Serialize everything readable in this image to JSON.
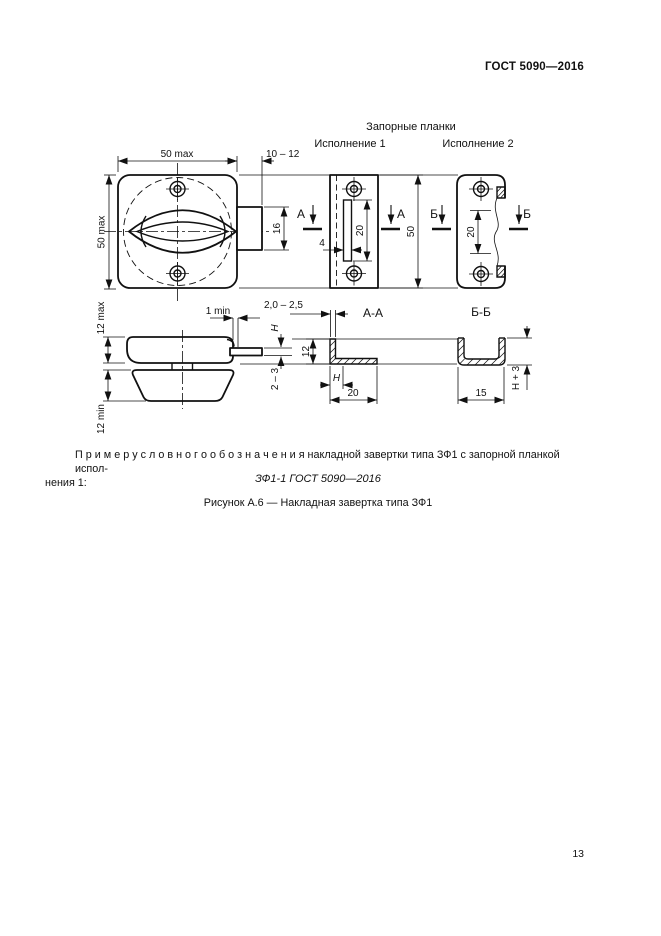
{
  "header": {
    "standard": "ГОСТ 5090—2016"
  },
  "figure": {
    "plates_title": "Запорные планки",
    "variant_1": "Исполнение 1",
    "variant_2": "Исполнение 2",
    "marker_a": "А",
    "marker_b": "Б",
    "section_aa": "А-А",
    "section_bb": "Б-Б",
    "dimensions": {
      "front_width": "50 max",
      "front_height": "50 max",
      "tongue_length": "10 – 12",
      "tongue_height": "16",
      "slot_width": "4",
      "slot_height": "20",
      "plate1_height": "50",
      "plate2_window_height": "20",
      "base_thickness": "12 max",
      "clearance": "1 min",
      "handle_height": "12 min",
      "tongue_offset": "H",
      "tongue_thickness": "2 – 3",
      "strip_thickness": "2,0 – 2,5",
      "aa_height": "12",
      "aa_hook": "H",
      "aa_width": "20",
      "bb_width": "15",
      "bb_height": "H + 3"
    }
  },
  "body": {
    "example_line_1": "П р и м е р   у с л о в н о г о   о б о з н а ч е н и я  накладной завертки типа ЗФ1 с запорной планкой испол-",
    "example_line_2": "нения 1:",
    "designation": "ЗФ1-1 ГОСТ 5090—2016",
    "figure_caption": "Рисунок А.6 — Накладная завертка типа ЗФ1"
  },
  "footer": {
    "page_number": "13"
  }
}
